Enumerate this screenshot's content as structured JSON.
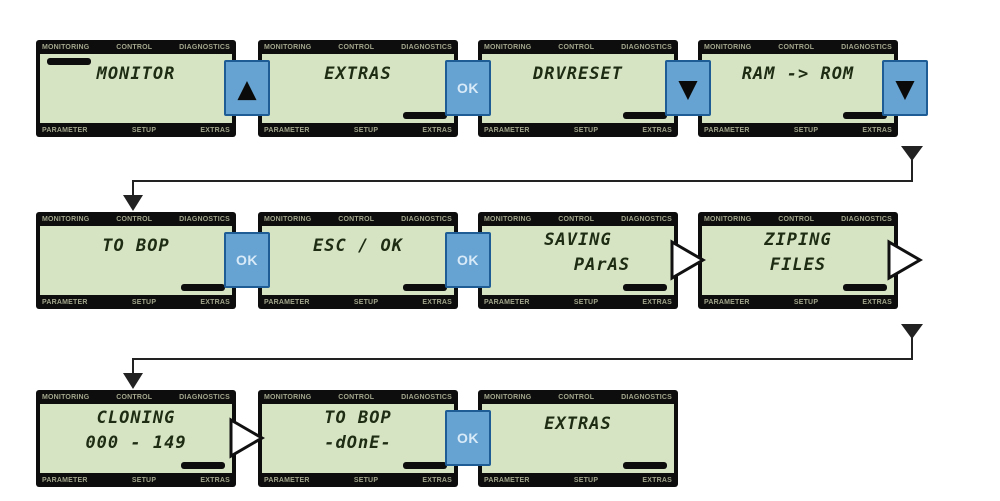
{
  "labels": {
    "top": [
      "MONITORING",
      "CONTROL",
      "DIAGNOSTICS"
    ],
    "bottom": [
      "PARAMETER",
      "SETUP",
      "EXTRAS"
    ]
  },
  "controls": {
    "up": "▲",
    "down": "▼",
    "ok": "OK"
  },
  "colors": {
    "lcd_background": "#d7e4c4",
    "bezel": "#0d0d0d",
    "button_blue": "#66a3d2",
    "button_border": "#1d5c94",
    "button_text": "#d8eaf8",
    "menu_label_text": "#a3a68c",
    "lcd_text": "#1d2c12"
  },
  "screens": [
    {
      "line1": "MONITOR",
      "line2": ""
    },
    {
      "line1": "EXTRAS",
      "line2": ""
    },
    {
      "line1": "DRVRESET",
      "line2": ""
    },
    {
      "line1": "RAM -> ROM",
      "line2": ""
    },
    {
      "line1": "TO BOP",
      "line2": ""
    },
    {
      "line1": "ESC / OK",
      "line2": ""
    },
    {
      "line1": "SAVING",
      "line2": "PArAS"
    },
    {
      "line1": "ZIPING",
      "line2": "FILES"
    },
    {
      "line1": "CLONING",
      "line2": "000 - 149"
    },
    {
      "line1": "TO BOP",
      "line2": "-dOnE-"
    },
    {
      "line1": "EXTRAS",
      "line2": ""
    }
  ]
}
